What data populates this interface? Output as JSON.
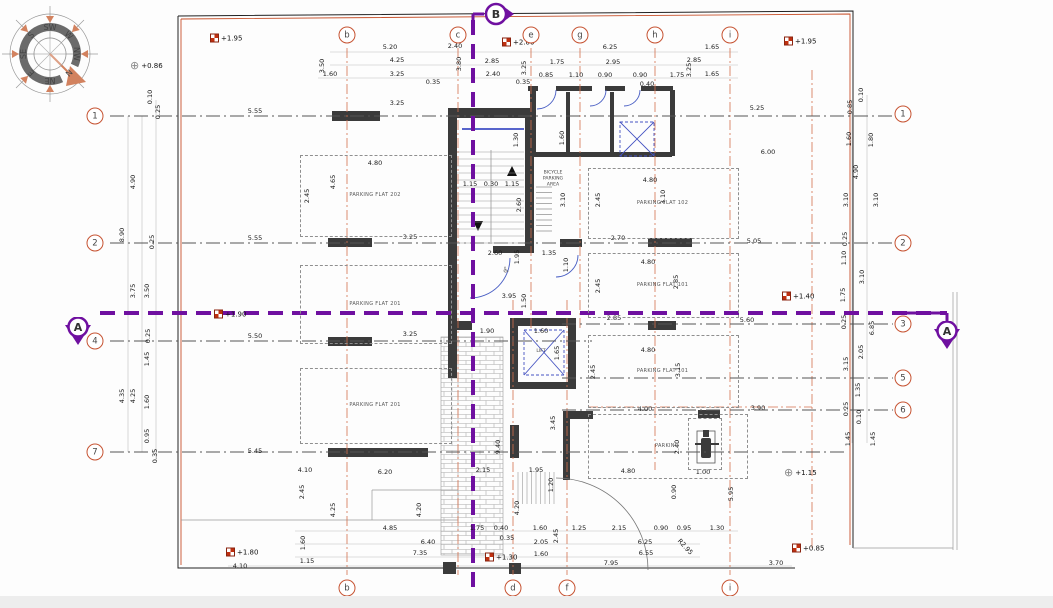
{
  "section_markers": {
    "a": "A",
    "b": "B"
  },
  "icons": {
    "wheelchair": "♿",
    "level_cross": "⊕"
  },
  "palette": {
    "grid_orange": "#c65332",
    "section_purple": "#6f10a0",
    "wall": "#3b3b3b",
    "door_blue": "#4553c2"
  },
  "compass": {
    "directions": [
      "SW",
      "W",
      "NW",
      "N",
      "NE",
      "E",
      "SE",
      "S"
    ]
  },
  "grid": {
    "cols": [
      {
        "label": "b",
        "x": 347,
        "top": true,
        "bottom": true,
        "y1": 48,
        "y2": 575
      },
      {
        "label": "c",
        "x": 458,
        "top": true,
        "bottom": false,
        "y1": 48,
        "y2": 575
      },
      {
        "label": "e",
        "x": 531,
        "top": true,
        "bottom": false,
        "y1": 48,
        "y2": 330
      },
      {
        "label": "g",
        "x": 580,
        "top": true,
        "bottom": false,
        "y1": 48,
        "y2": 330
      },
      {
        "label": "h",
        "x": 655,
        "top": true,
        "bottom": false,
        "y1": 48,
        "y2": 470
      },
      {
        "label": "i",
        "x": 730,
        "top": true,
        "bottom": true,
        "y1": 48,
        "y2": 575
      },
      {
        "label": "d",
        "x": 513,
        "top": false,
        "bottom": true,
        "y1": 300,
        "y2": 575
      },
      {
        "label": "f",
        "x": 567,
        "top": false,
        "bottom": true,
        "y1": 300,
        "y2": 575
      }
    ],
    "rows": [
      {
        "label": "1",
        "y": 116,
        "left": true,
        "right": true,
        "ry": 114,
        "x1": 110,
        "x2": 893
      },
      {
        "label": "2",
        "y": 243,
        "left": true,
        "right": true,
        "ry": 243,
        "x1": 110,
        "x2": 893
      },
      {
        "label": "4",
        "y": 341,
        "left": true,
        "right": false,
        "x1": 110,
        "x2": 592
      },
      {
        "label": "7",
        "y": 452,
        "left": true,
        "right": false,
        "x1": 110,
        "x2": 848
      },
      {
        "label": "3",
        "y": 324,
        "left": false,
        "right": true,
        "x1": 562,
        "x2": 893
      },
      {
        "label": "5",
        "y": 378,
        "left": false,
        "right": true,
        "x1": 562,
        "x2": 893
      },
      {
        "label": "6",
        "y": 410,
        "left": false,
        "right": true,
        "x1": 562,
        "x2": 893
      }
    ]
  },
  "rooms": [
    {
      "label": "PARKING FLAT 202",
      "x": 300,
      "y": 155,
      "w": 150,
      "h": 80
    },
    {
      "label": "PARKING FLAT 201",
      "x": 300,
      "y": 265,
      "w": 150,
      "h": 77
    },
    {
      "label": "PARKING FLAT 201",
      "x": 300,
      "y": 368,
      "w": 150,
      "h": 74
    },
    {
      "label": "PARKING FLAT 102",
      "x": 588,
      "y": 168,
      "w": 149,
      "h": 69
    },
    {
      "label": "PARKING FLAT 101",
      "x": 588,
      "y": 253,
      "w": 149,
      "h": 63
    },
    {
      "label": "PARKING FLAT 101",
      "x": 588,
      "y": 335,
      "w": 149,
      "h": 71
    },
    {
      "label": "PARKING",
      "x": 588,
      "y": 414,
      "w": 158,
      "h": 63
    },
    {
      "label": "",
      "x": 688,
      "y": 418,
      "w": 32,
      "h": 50
    }
  ],
  "area_labels": [
    {
      "text": "BICYCLE\nPARKING\nAREA",
      "x": 553,
      "y": 180
    },
    {
      "text": "LIFT",
      "x": 541,
      "y": 352
    }
  ],
  "levels": [
    {
      "t": "+1.95",
      "x": 210,
      "y": 38,
      "s": "spot"
    },
    {
      "t": "+0.86",
      "x": 130,
      "y": 66,
      "s": "cross"
    },
    {
      "t": "+2.00",
      "x": 502,
      "y": 42,
      "s": "spot"
    },
    {
      "t": "+1.95",
      "x": 784,
      "y": 41,
      "s": "spot"
    },
    {
      "t": "+1.90",
      "x": 214,
      "y": 314,
      "s": "spot"
    },
    {
      "t": "+1.40",
      "x": 782,
      "y": 296,
      "s": "spot"
    },
    {
      "t": "+1.15",
      "x": 784,
      "y": 473,
      "s": "cross"
    },
    {
      "t": "+1.80",
      "x": 226,
      "y": 552,
      "s": "spot"
    },
    {
      "t": "+1.30",
      "x": 485,
      "y": 557,
      "s": "spot"
    },
    {
      "t": "+0.85",
      "x": 792,
      "y": 548,
      "s": "spot"
    }
  ],
  "dims": [
    [
      "5.20",
      390,
      47
    ],
    [
      "2.40",
      455,
      46
    ],
    [
      "6.25",
      610,
      47
    ],
    [
      "1.65",
      712,
      47
    ],
    [
      "4.25",
      397,
      60
    ],
    [
      "2.85",
      492,
      61
    ],
    [
      "1.75",
      557,
      62
    ],
    [
      "2.95",
      613,
      62
    ],
    [
      "2.85",
      694,
      60
    ],
    [
      "1.60",
      330,
      74
    ],
    [
      "3.25",
      397,
      74
    ],
    [
      "2.40",
      493,
      74
    ],
    [
      "0.85",
      546,
      75
    ],
    [
      "1.10",
      576,
      75
    ],
    [
      "0.90",
      605,
      75
    ],
    [
      "0.90",
      640,
      75
    ],
    [
      "1.75",
      677,
      75
    ],
    [
      "1.65",
      712,
      74
    ],
    [
      "0.35",
      433,
      82
    ],
    [
      "0.35",
      523,
      82
    ],
    [
      "0.40",
      647,
      84
    ],
    [
      "3.50",
      322,
      66,
      90
    ],
    [
      "3.80",
      459,
      64,
      90
    ],
    [
      "3.25",
      524,
      68,
      90
    ],
    [
      "3.25",
      689,
      70,
      90
    ],
    [
      "3.25",
      397,
      103
    ],
    [
      "5.55",
      255,
      111
    ],
    [
      "5.25",
      757,
      108
    ],
    [
      "6.00",
      768,
      152
    ],
    [
      "1.60",
      562,
      138,
      90
    ],
    [
      "1.30",
      516,
      140,
      90
    ],
    [
      "4.80",
      375,
      163
    ],
    [
      "2.45",
      307,
      196,
      90
    ],
    [
      "4.65",
      333,
      182,
      90
    ],
    [
      "4.90",
      133,
      182,
      90
    ],
    [
      "8.90",
      122,
      235,
      90
    ],
    [
      "0.10",
      150,
      97,
      90
    ],
    [
      "0.25",
      158,
      112,
      90
    ],
    [
      "1.15",
      470,
      184
    ],
    [
      "0.30",
      491,
      184
    ],
    [
      "1.15",
      512,
      184
    ],
    [
      "2.60",
      519,
      205,
      90
    ],
    [
      "4.80",
      650,
      180
    ],
    [
      "2.45",
      598,
      200,
      90
    ],
    [
      "3.10",
      563,
      200,
      90
    ],
    [
      "3.10",
      663,
      197,
      90
    ],
    [
      "2.70",
      618,
      238
    ],
    [
      "3.25",
      410,
      237
    ],
    [
      "5.55",
      255,
      238
    ],
    [
      "5.05",
      754,
      241
    ],
    [
      "0.25",
      152,
      242,
      90
    ],
    [
      "2.60",
      495,
      253
    ],
    [
      "1.95",
      517,
      257,
      90
    ],
    [
      "1.35",
      549,
      253
    ],
    [
      "1.10",
      566,
      265,
      90
    ],
    [
      "3.95",
      509,
      296
    ],
    [
      "1.50",
      524,
      301,
      90
    ],
    [
      "4.80",
      648,
      262
    ],
    [
      "2.45",
      598,
      286,
      90
    ],
    [
      "2.85",
      676,
      282,
      90
    ],
    [
      "2.85",
      614,
      318
    ],
    [
      "5.60",
      747,
      320
    ],
    [
      "3.75",
      133,
      291,
      90
    ],
    [
      "3.50",
      147,
      291,
      90
    ],
    [
      "5.50",
      255,
      336
    ],
    [
      "3.25",
      410,
      334
    ],
    [
      "0.25",
      148,
      336,
      90
    ],
    [
      "1.45",
      147,
      359,
      90
    ],
    [
      "1.90",
      487,
      331
    ],
    [
      "1.60",
      541,
      331
    ],
    [
      "1.65",
      557,
      353,
      90
    ],
    [
      "4.80",
      648,
      350
    ],
    [
      "2.45",
      593,
      372,
      90
    ],
    [
      "3.15",
      678,
      370,
      90
    ],
    [
      "4.00",
      645,
      409
    ],
    [
      "3.90",
      758,
      408
    ],
    [
      "4.35",
      122,
      396,
      90
    ],
    [
      "4.25",
      133,
      396,
      90
    ],
    [
      "1.60",
      147,
      402,
      90
    ],
    [
      "0.95",
      147,
      436,
      90
    ],
    [
      "0.35",
      155,
      456,
      90
    ],
    [
      "5.45",
      255,
      451
    ],
    [
      "2.40",
      677,
      447,
      90
    ],
    [
      "1.00",
      703,
      472
    ],
    [
      "4.80",
      628,
      471
    ],
    [
      "0.90",
      674,
      492,
      90
    ],
    [
      "5.95",
      731,
      494,
      90
    ],
    [
      "3.45",
      553,
      423,
      90
    ],
    [
      "9.40",
      498,
      447,
      90
    ],
    [
      "2.15",
      483,
      470
    ],
    [
      "1.95",
      536,
      470
    ],
    [
      "4.10",
      305,
      470
    ],
    [
      "6.20",
      385,
      472
    ],
    [
      "1.20",
      551,
      485,
      90
    ],
    [
      "4.20",
      517,
      508,
      90
    ],
    [
      "2.45",
      302,
      492,
      90
    ],
    [
      "4.25",
      333,
      510,
      90
    ],
    [
      "4.20",
      419,
      510,
      90
    ],
    [
      "4.85",
      390,
      528
    ],
    [
      "1.75",
      477,
      528
    ],
    [
      "0.40",
      501,
      528
    ],
    [
      "6.40",
      428,
      542
    ],
    [
      "0.35",
      507,
      538
    ],
    [
      "7.35",
      420,
      553
    ],
    [
      "1.60",
      303,
      543,
      90
    ],
    [
      "1.15",
      307,
      561
    ],
    [
      "4.10",
      240,
      566
    ],
    [
      "1.60",
      540,
      528
    ],
    [
      "2.45",
      556,
      536,
      90
    ],
    [
      "1.25",
      579,
      528
    ],
    [
      "2.15",
      619,
      528
    ],
    [
      "0.90",
      661,
      528
    ],
    [
      "0.95",
      684,
      528
    ],
    [
      "1.30",
      717,
      528
    ],
    [
      "2.05",
      541,
      542
    ],
    [
      "6.25",
      645,
      542
    ],
    [
      "1.60",
      541,
      554
    ],
    [
      "6.55",
      646,
      553
    ],
    [
      "7.95",
      611,
      563
    ],
    [
      "R2.95",
      685,
      547,
      -47
    ],
    [
      "3.70",
      776,
      563
    ],
    [
      "0.10",
      861,
      95,
      90
    ],
    [
      "0.85",
      850,
      107,
      90
    ],
    [
      "1.60",
      849,
      139,
      90
    ],
    [
      "1.80",
      871,
      140,
      90
    ],
    [
      "4.90",
      856,
      172,
      90
    ],
    [
      "3.10",
      846,
      200,
      90
    ],
    [
      "3.10",
      876,
      200,
      90
    ],
    [
      "0.25",
      845,
      239,
      90
    ],
    [
      "1.10",
      844,
      258,
      90
    ],
    [
      "3.10",
      862,
      277,
      90
    ],
    [
      "1.75",
      843,
      295,
      90
    ],
    [
      "0.25",
      844,
      322,
      90
    ],
    [
      "6.85",
      872,
      328,
      90
    ],
    [
      "2.05",
      861,
      352,
      90
    ],
    [
      "3.15",
      846,
      364,
      90
    ],
    [
      "1.35",
      858,
      390,
      90
    ],
    [
      "0.25",
      846,
      409,
      90
    ],
    [
      "0.10",
      859,
      417,
      90
    ],
    [
      "1.45",
      848,
      439,
      90
    ],
    [
      "1.45",
      873,
      439,
      90
    ]
  ]
}
